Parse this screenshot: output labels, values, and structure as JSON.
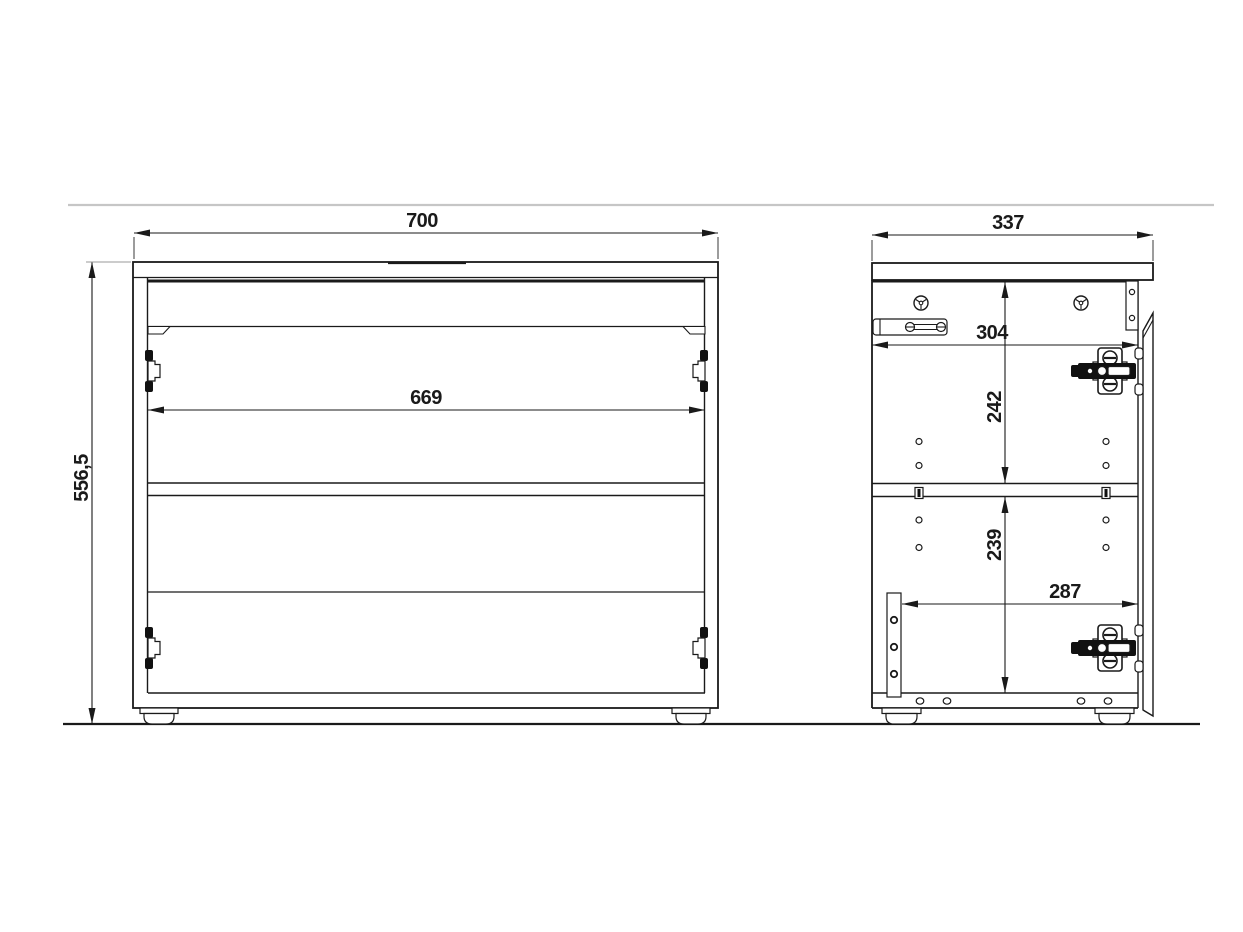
{
  "drawing": {
    "type": "furniture-technical-drawing",
    "views": {
      "front": {
        "label": "front-view",
        "dims": {
          "overall_width": "700",
          "overall_height": "556,5",
          "inner_width": "669"
        }
      },
      "side": {
        "label": "side-view",
        "dims": {
          "overall_depth": "337",
          "upper_inner_depth": "304",
          "upper_compartment_height": "242",
          "lower_compartment_height": "239",
          "lower_inner_depth": "287"
        }
      }
    },
    "colors": {
      "line": "#1a1a1a",
      "divider": "#c6c6c6",
      "background": "#ffffff"
    }
  }
}
